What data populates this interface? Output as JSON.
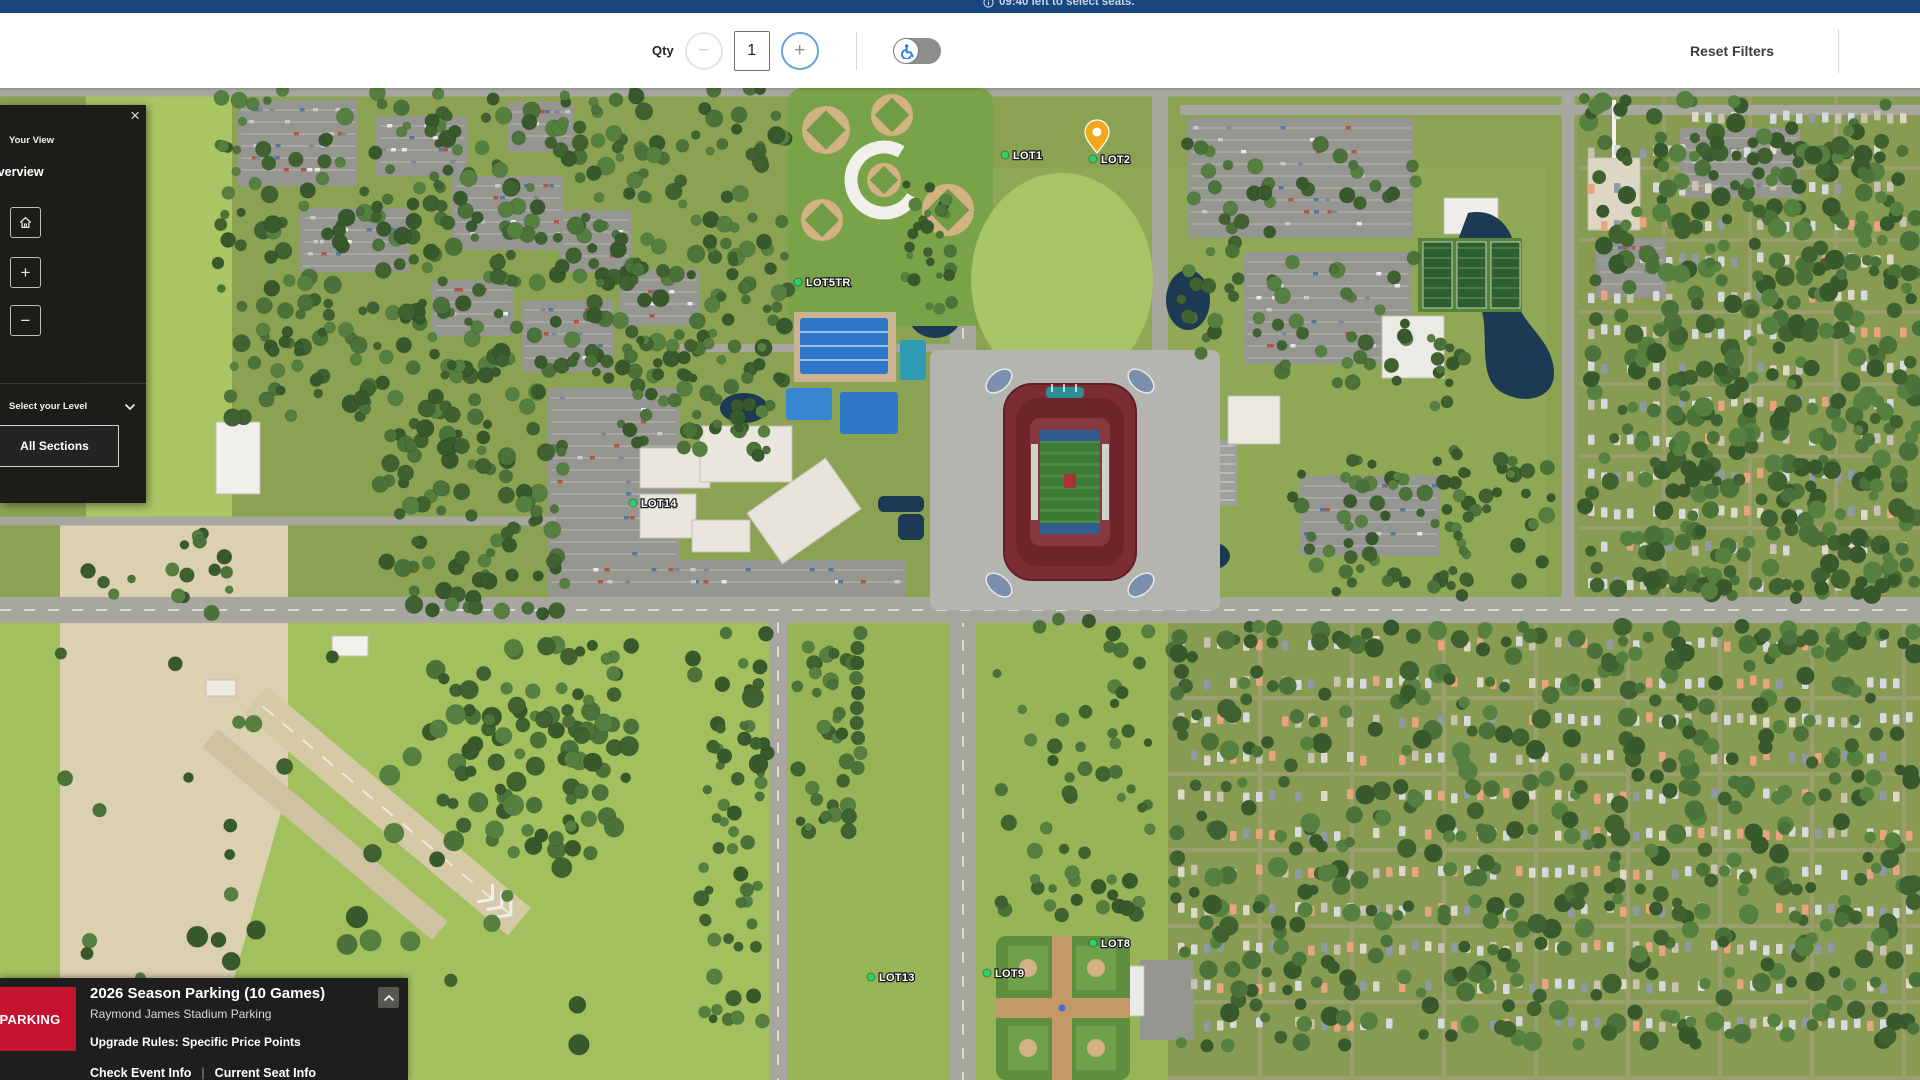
{
  "top_bar": {
    "timer_text": "09:40 left to select seats.",
    "info_icon": "info-icon",
    "bg_color": "#17477e"
  },
  "toolbar": {
    "qty_label": "Qty",
    "qty_value": "1",
    "minus_label": "−",
    "plus_label": "+",
    "accessibility_icon": "wheelchair-icon",
    "accessibility_state": "off",
    "reset_filters_label": "Reset Filters"
  },
  "view_panel": {
    "close_icon": "×",
    "tab_label": "Your View",
    "title": "Overview",
    "home_icon": "home-icon",
    "zoom_in_label": "+",
    "zoom_out_label": "−",
    "level_label": "Select your Level",
    "level_chevron_icon": "chevron-down-icon",
    "all_sections_label": "All Sections"
  },
  "event_panel": {
    "badge": "PARKING",
    "badge_color": "#c41230",
    "title": "2026 Season Parking (10 Games)",
    "subtitle": "Raymond James Stadium Parking",
    "upgrade_rules": "Upgrade Rules: Specific Price Points",
    "links": [
      "Check Event Info",
      "Current Seat Info"
    ],
    "link_separator": "|",
    "collapse_icon": "chevron-up-icon"
  },
  "map": {
    "type": "aerial-3d-venue-map",
    "marker_dot_color": "#2fd06b",
    "pin_color": "#f2a71b",
    "lots": [
      {
        "name": "LOT1",
        "x": 1005,
        "y": 67
      },
      {
        "name": "LOT2",
        "x": 1093,
        "y": 71,
        "pin": true
      },
      {
        "name": "LOT5TR",
        "x": 798,
        "y": 194
      },
      {
        "name": "LOT14",
        "x": 633,
        "y": 415
      },
      {
        "name": "LOT13",
        "x": 871,
        "y": 889
      },
      {
        "name": "LOT9",
        "x": 987,
        "y": 885
      },
      {
        "name": "LOT8",
        "x": 1093,
        "y": 855
      }
    ]
  }
}
